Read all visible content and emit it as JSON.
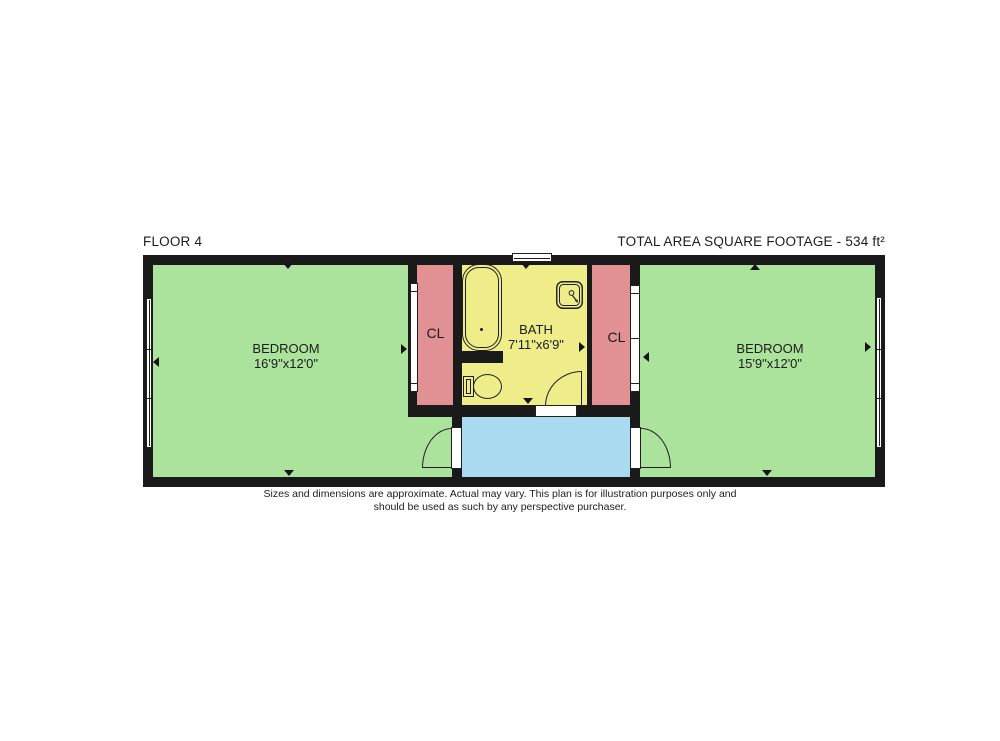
{
  "header": {
    "floor_label": "FLOOR 4",
    "total_area": "TOTAL AREA SQUARE FOOTAGE - 534 ft²"
  },
  "rooms": {
    "bedroom_left": {
      "name": "BEDROOM",
      "dims": "16'9\"x12'0\""
    },
    "bedroom_right": {
      "name": "BEDROOM",
      "dims": "15'9\"x12'0\""
    },
    "bath": {
      "name": "BATH",
      "dims": "7'11\"x6'9\""
    },
    "closet_left": {
      "label": "CL"
    },
    "closet_right": {
      "label": "CL"
    }
  },
  "footer": {
    "line1": "Sizes and dimensions are approximate. Actual may vary. This plan is for illustration purposes only and",
    "line2": "should be used as such by any perspective purchaser."
  },
  "colors": {
    "bedroom": "#abe39c",
    "closet": "#e19093",
    "bath": "#efec8a",
    "hall": "#a9daf0",
    "wall": "#1a1a1a"
  }
}
